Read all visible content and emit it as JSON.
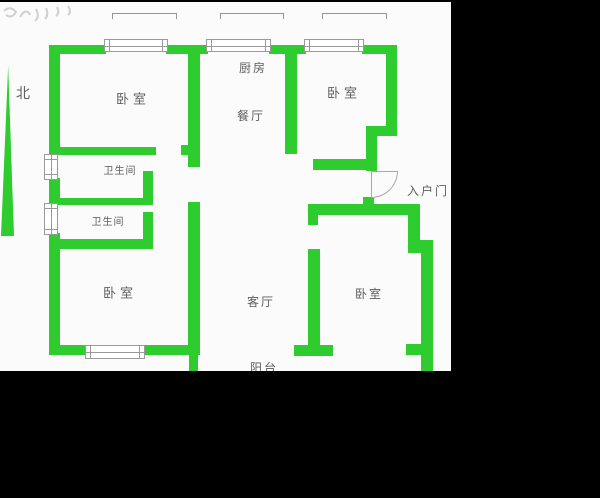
{
  "plan": {
    "compass_label": "北",
    "rooms": {
      "bedroom_nw": "卧室",
      "kitchen": "厨房",
      "dining": "餐厅",
      "bedroom_ne": "卧室",
      "bath_upper": "卫生间",
      "bath_lower": "卫生间",
      "bedroom_sw": "卧室",
      "living": "客厅",
      "bedroom_se": "卧室",
      "balcony": "阳台",
      "entry_door": "入户门"
    },
    "colors": {
      "wall_green": "#2ecc2e",
      "plan_background": "#fbfbfb",
      "frame_black": "#000000",
      "detail_gray": "#9a9a9a",
      "text_gray": "#5e5e5e"
    }
  }
}
